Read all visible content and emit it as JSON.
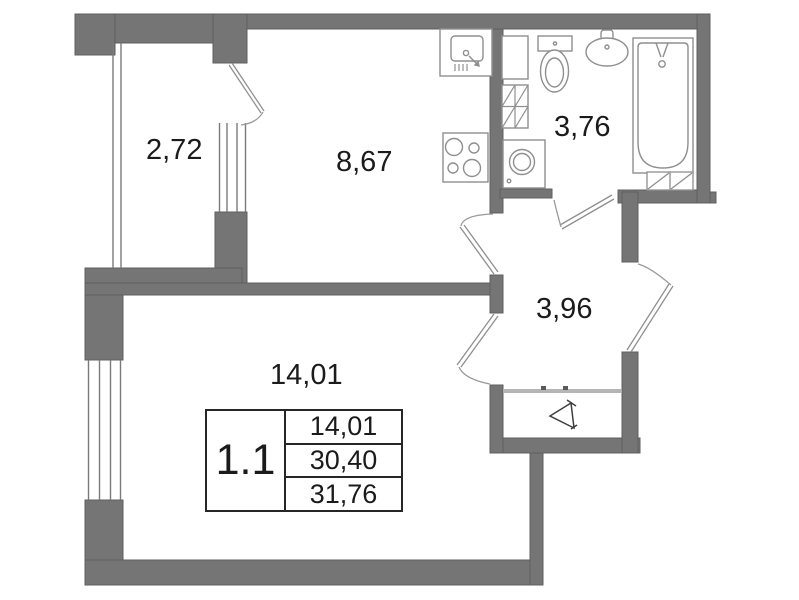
{
  "unit_card": {
    "unit_number": "1.1",
    "areas": [
      "14,01",
      "30,40",
      "31,76"
    ]
  },
  "room_labels": {
    "balcony": "2,72",
    "kitchen": "8,67",
    "bathroom": "3,76",
    "hallway": "3,96",
    "living_room": "14,01"
  },
  "colors": {
    "wall": "#757575",
    "wall_edge": "#5f5f5f",
    "fixture_line": "#8f8f8f",
    "door_arc": "#9a9a9a",
    "wardrobe_track": "#b5b5b5",
    "text": "#1b1b1b",
    "background": "#ffffff"
  }
}
